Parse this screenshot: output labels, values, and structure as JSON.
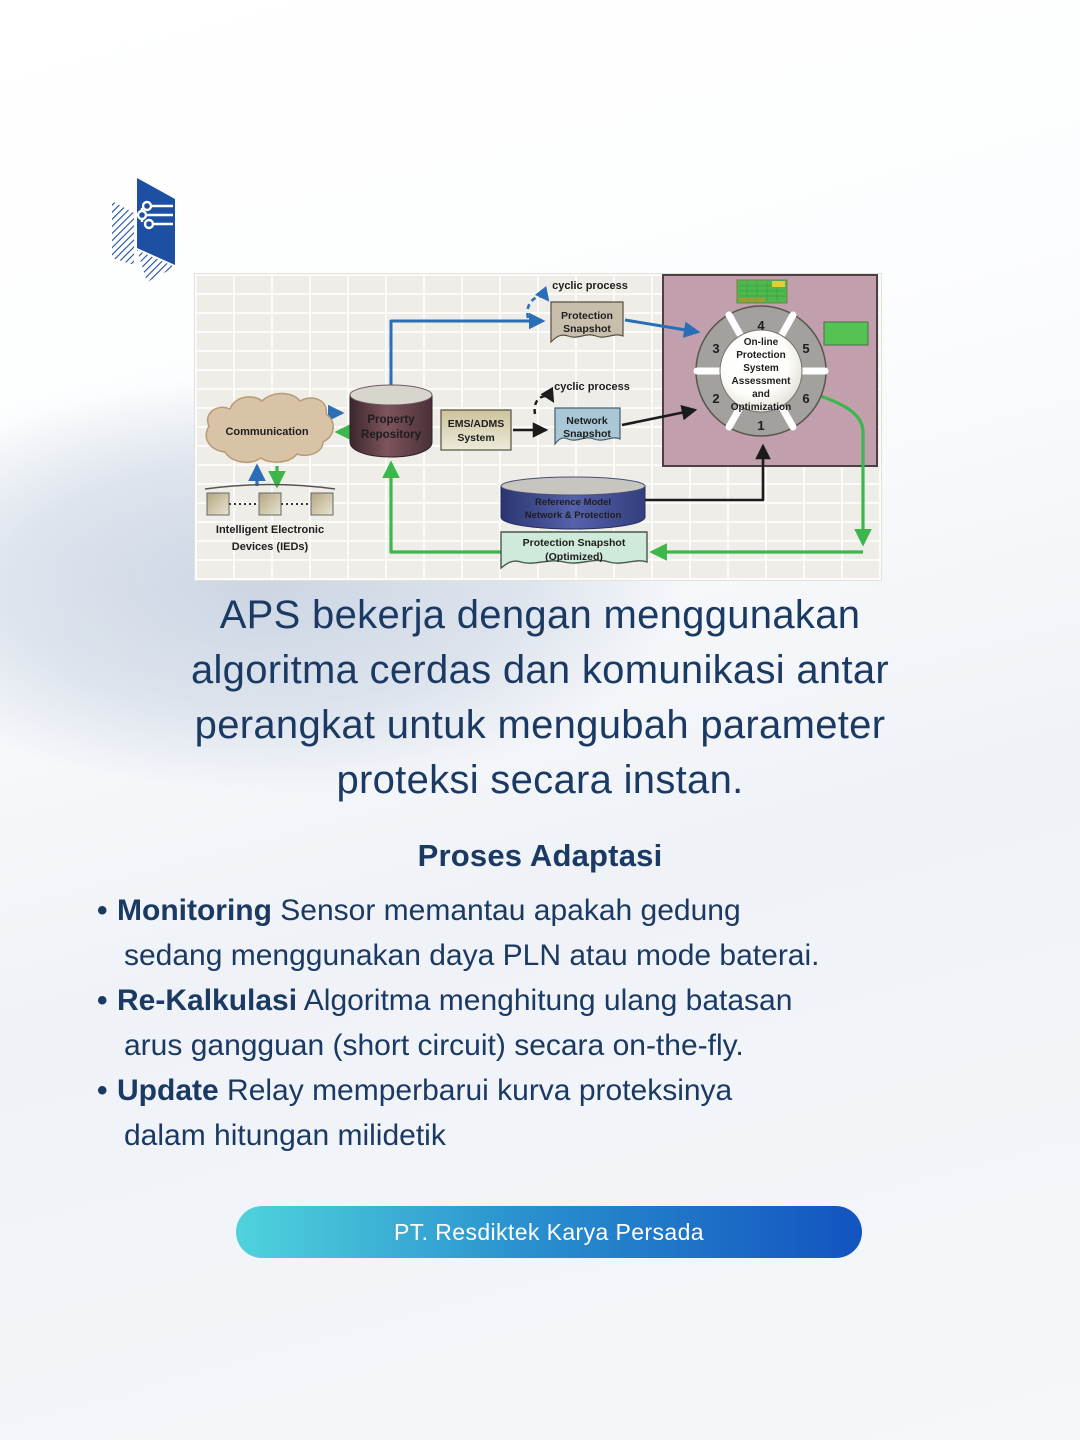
{
  "page": {
    "accent_navy": "#1b3a63",
    "background": "#f4f6fa"
  },
  "logo": {
    "name": "Resdiktek book-circuit logo",
    "color": "#1d4fa3"
  },
  "diagram": {
    "cloud_label": "Communication",
    "ieds_label_1": "Intelligent Electronic",
    "ieds_label_2": "Devices (IEDs)",
    "repository_1": "Property",
    "repository_2": "Repository",
    "ems_1": "EMS/ADMS",
    "ems_2": "System",
    "cyclic_top": "cyclic process",
    "cyclic_mid": "cyclic process",
    "protection_snapshot_1": "Protection",
    "protection_snapshot_2": "Snapshot",
    "network_snapshot_1": "Network",
    "network_snapshot_2": "Snapshot",
    "reference_model_1": "Reference Model",
    "reference_model_2": "Network & Protection",
    "optimized_1": "Protection Snapshot",
    "optimized_2": "(Optimized)",
    "ring": {
      "center_lines": [
        "On-line",
        "Protection",
        "System",
        "Assessment",
        "and",
        "Optimization"
      ],
      "numbers": [
        "1",
        "2",
        "3",
        "4",
        "5",
        "6"
      ]
    },
    "colors": {
      "panel_pink": "#c19fac",
      "arrow_blue": "#2a6fb5",
      "arrow_green": "#3db64b",
      "arrow_black": "#1b1b1b",
      "repository_maroon": "#5d3e45",
      "reference_blue": "#36418c",
      "cloud_tan": "#d9c3a6",
      "snapshot_tan": "#c8beac",
      "snapshot_blue": "#a9c7d7",
      "snapshot_green": "#cfe9da",
      "ring_gray": "#a3a19d",
      "green_box": "#55c353"
    }
  },
  "headline": {
    "lines": [
      "APS bekerja dengan menggunakan",
      "algoritma cerdas dan komunikasi antar",
      "perangkat untuk mengubah parameter",
      "proteksi secara instan."
    ]
  },
  "section": {
    "title": "Proses Adaptasi"
  },
  "bullets": [
    {
      "bold": "Monitoring",
      "rest": "Sensor memantau apakah gedung",
      "cont": "sedang menggunakan daya PLN atau mode baterai."
    },
    {
      "bold": "Re-Kalkulasi",
      "rest": "Algoritma menghitung ulang batasan",
      "cont": "arus gangguan (short circuit) secara on-the-fly."
    },
    {
      "bold": "Update",
      "rest": "Relay memperbarui kurva proteksinya",
      "cont": "dalam hitungan milidetik"
    }
  ],
  "footer": {
    "button_label": "PT. Resdiktek Karya Persada",
    "gradient": [
      "#50d3dc",
      "#1353c0"
    ]
  }
}
